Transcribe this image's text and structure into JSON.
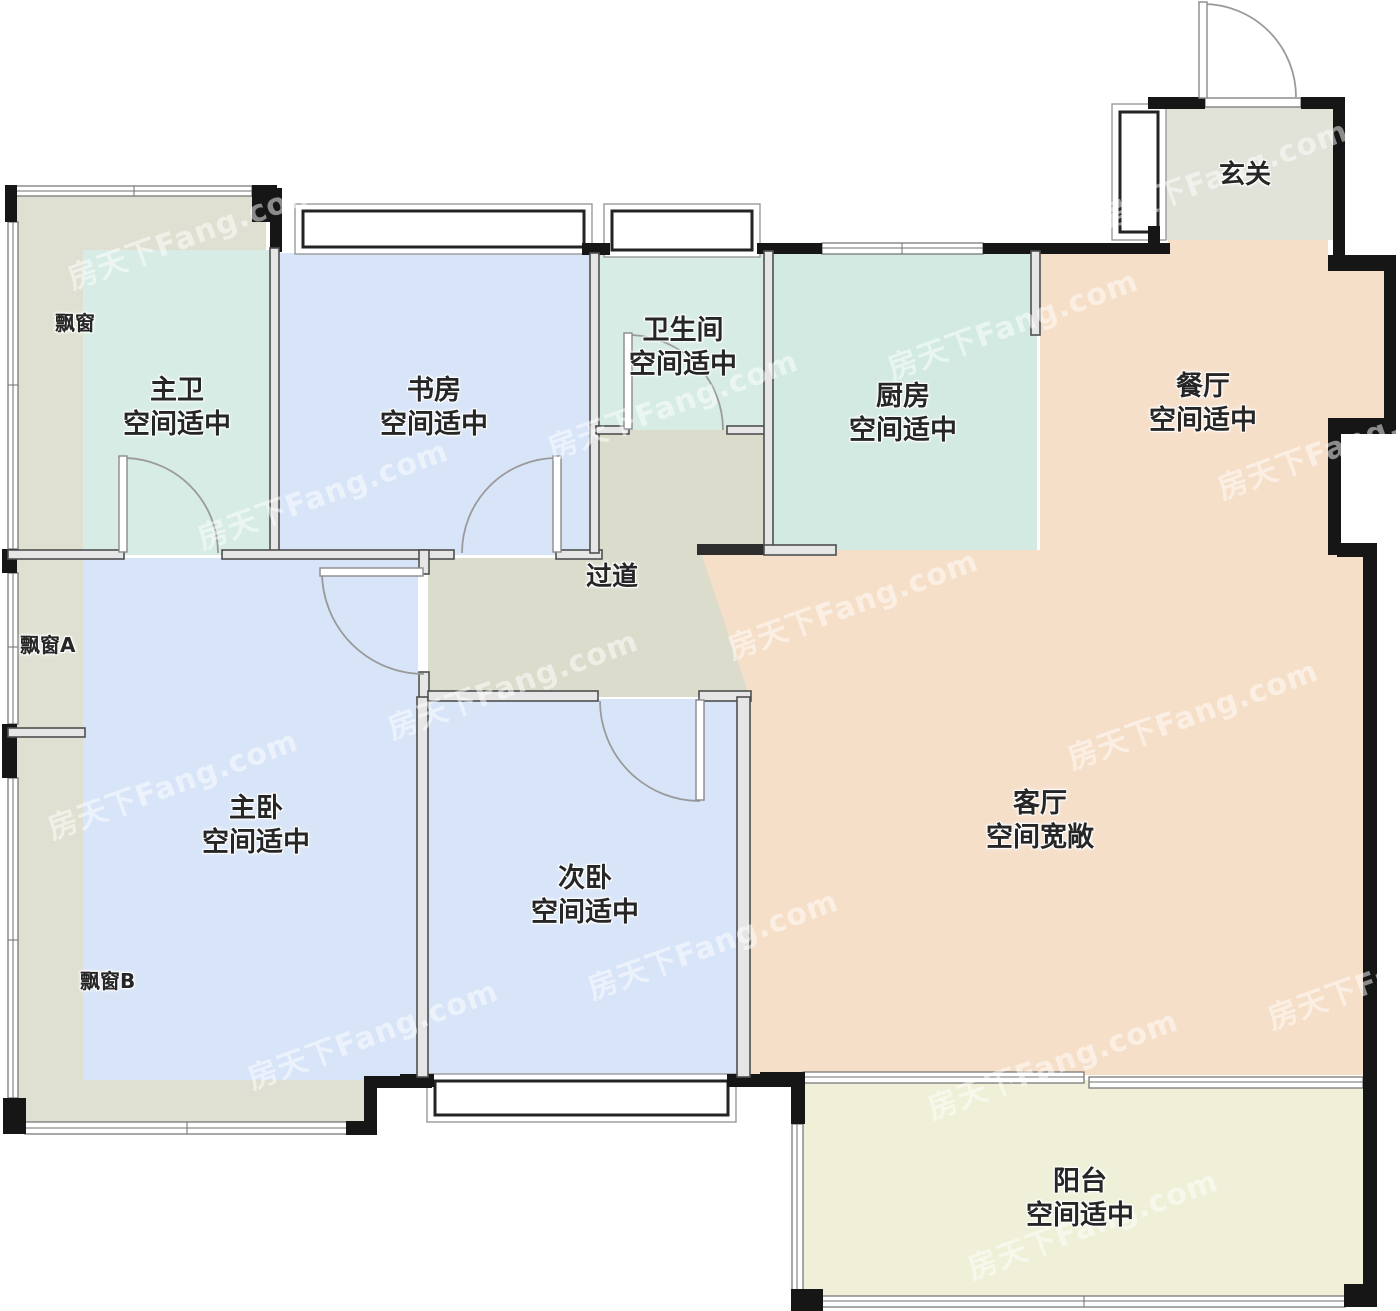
{
  "watermark": {
    "text": "房天下Fang.com"
  },
  "colors": {
    "wall_black": "#161616",
    "bay_beige": "#e0e0d2",
    "entry_beige": "#e1e2d8",
    "corridor_beige": "#dcdccd",
    "bath_mint": "#d7ece5",
    "kitchen_mint": "#d2eae1",
    "bedroom_blue": "#d8e5f8",
    "living_peach": "#f6dfc9",
    "balcony_cream": "#eff0d7"
  },
  "rooms": {
    "xuanguan": {
      "name": "玄关"
    },
    "piaochuang": {
      "name": "飘窗"
    },
    "piaochuang_a": {
      "name": "飘窗A"
    },
    "piaochuang_b": {
      "name": "飘窗B"
    },
    "guodao": {
      "name": "过道"
    },
    "zhuwei": {
      "name": "主卫",
      "desc": "空间适中"
    },
    "shufang": {
      "name": "书房",
      "desc": "空间适中"
    },
    "weishengjian": {
      "name": "卫生间",
      "desc": "空间适中"
    },
    "chufang": {
      "name": "厨房",
      "desc": "空间适中"
    },
    "canting": {
      "name": "餐厅",
      "desc": "空间适中"
    },
    "zhuwo": {
      "name": "主卧",
      "desc": "空间适中"
    },
    "ciwo": {
      "name": "次卧",
      "desc": "空间适中"
    },
    "keting": {
      "name": "客厅",
      "desc": "空间宽敞"
    },
    "yangtai": {
      "name": "阳台",
      "desc": "空间适中"
    }
  }
}
